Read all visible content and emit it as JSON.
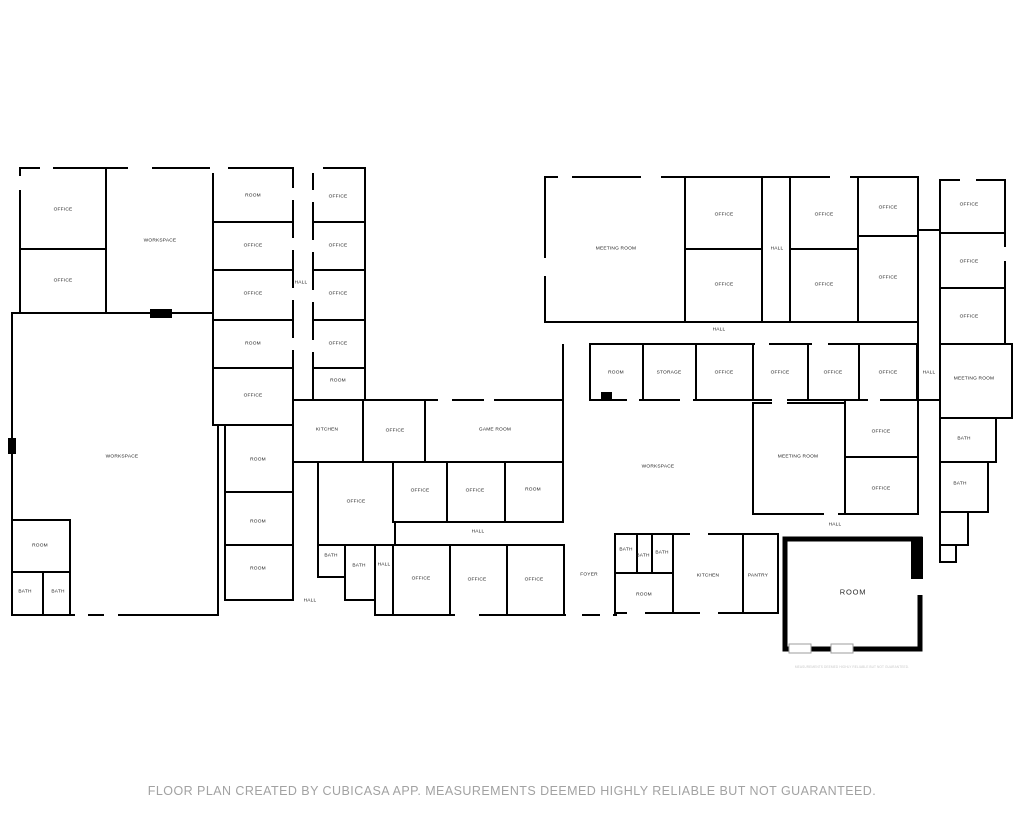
{
  "canvas": {
    "background": "#ffffff",
    "wall_color": "#000000",
    "label_color": "#1b1b1b",
    "muted_text_color": "#a2a2a2"
  },
  "footer": {
    "disclaimer": "FLOOR PLAN CREATED BY CUBICASA APP. MEASUREMENTS DEEMED HIGHLY RELIABLE BUT NOT GUARANTEED.",
    "fine_print": "MEASUREMENTS DEEMED HIGHLY RELIABLE BUT NOT GUARANTEED."
  },
  "rooms": [
    {
      "label": "OFFICE",
      "x": 63,
      "y": 211
    },
    {
      "label": "OFFICE",
      "x": 63,
      "y": 282
    },
    {
      "label": "WORKSPACE",
      "x": 160,
      "y": 242
    },
    {
      "label": "ROOM",
      "x": 253,
      "y": 197
    },
    {
      "label": "OFFICE",
      "x": 253,
      "y": 247
    },
    {
      "label": "OFFICE",
      "x": 253,
      "y": 295
    },
    {
      "label": "ROOM",
      "x": 253,
      "y": 345
    },
    {
      "label": "OFFICE",
      "x": 253,
      "y": 397
    },
    {
      "label": "HALL",
      "x": 301,
      "y": 284
    },
    {
      "label": "OFFICE",
      "x": 338,
      "y": 198
    },
    {
      "label": "OFFICE",
      "x": 338,
      "y": 247
    },
    {
      "label": "OFFICE",
      "x": 338,
      "y": 295
    },
    {
      "label": "OFFICE",
      "x": 338,
      "y": 345
    },
    {
      "label": "ROOM",
      "x": 338,
      "y": 382
    },
    {
      "label": "WORKSPACE",
      "x": 122,
      "y": 458
    },
    {
      "label": "ROOM",
      "x": 258,
      "y": 461
    },
    {
      "label": "ROOM",
      "x": 258,
      "y": 523
    },
    {
      "label": "ROOM",
      "x": 258,
      "y": 570
    },
    {
      "label": "ROOM",
      "x": 40,
      "y": 547
    },
    {
      "label": "BATH",
      "x": 25,
      "y": 593
    },
    {
      "label": "BATH",
      "x": 58,
      "y": 593
    },
    {
      "label": "KITCHEN",
      "x": 327,
      "y": 431
    },
    {
      "label": "OFFICE",
      "x": 356,
      "y": 503
    },
    {
      "label": "BATH",
      "x": 331,
      "y": 557
    },
    {
      "label": "BATH",
      "x": 359,
      "y": 567
    },
    {
      "label": "HALL",
      "x": 384,
      "y": 566
    },
    {
      "label": "HALL",
      "x": 310,
      "y": 602
    },
    {
      "label": "OFFICE",
      "x": 395,
      "y": 432
    },
    {
      "label": "GAME ROOM",
      "x": 495,
      "y": 431
    },
    {
      "label": "OFFICE",
      "x": 420,
      "y": 492
    },
    {
      "label": "OFFICE",
      "x": 475,
      "y": 492
    },
    {
      "label": "ROOM",
      "x": 533,
      "y": 491
    },
    {
      "label": "HALL",
      "x": 478,
      "y": 533
    },
    {
      "label": "OFFICE",
      "x": 421,
      "y": 580
    },
    {
      "label": "OFFICE",
      "x": 477,
      "y": 581
    },
    {
      "label": "OFFICE",
      "x": 534,
      "y": 581
    },
    {
      "label": "FOYER",
      "x": 589,
      "y": 576
    },
    {
      "label": "MEETING ROOM",
      "x": 616,
      "y": 250
    },
    {
      "label": "OFFICE",
      "x": 724,
      "y": 216
    },
    {
      "label": "OFFICE",
      "x": 724,
      "y": 286
    },
    {
      "label": "HALL",
      "x": 777,
      "y": 250
    },
    {
      "label": "HALL",
      "x": 719,
      "y": 331
    },
    {
      "label": "OFFICE",
      "x": 824,
      "y": 216
    },
    {
      "label": "OFFICE",
      "x": 888,
      "y": 209
    },
    {
      "label": "OFFICE",
      "x": 824,
      "y": 286
    },
    {
      "label": "OFFICE",
      "x": 888,
      "y": 279
    },
    {
      "label": "OFFICE",
      "x": 969,
      "y": 206
    },
    {
      "label": "OFFICE",
      "x": 969,
      "y": 263
    },
    {
      "label": "OFFICE",
      "x": 969,
      "y": 318
    },
    {
      "label": "HALL",
      "x": 929,
      "y": 374
    },
    {
      "label": "MEETING ROOM",
      "x": 974,
      "y": 380
    },
    {
      "label": "BATH",
      "x": 964,
      "y": 440
    },
    {
      "label": "BATH",
      "x": 960,
      "y": 485
    },
    {
      "label": "ROOM",
      "x": 616,
      "y": 374
    },
    {
      "label": "STORAGE",
      "x": 669,
      "y": 374
    },
    {
      "label": "OFFICE",
      "x": 724,
      "y": 374
    },
    {
      "label": "OFFICE",
      "x": 780,
      "y": 374
    },
    {
      "label": "OFFICE",
      "x": 833,
      "y": 374
    },
    {
      "label": "OFFICE",
      "x": 888,
      "y": 374
    },
    {
      "label": "WORKSPACE",
      "x": 658,
      "y": 468
    },
    {
      "label": "MEETING ROOM",
      "x": 798,
      "y": 458
    },
    {
      "label": "OFFICE",
      "x": 881,
      "y": 433
    },
    {
      "label": "OFFICE",
      "x": 881,
      "y": 490
    },
    {
      "label": "HALL",
      "x": 835,
      "y": 526
    },
    {
      "label": "BATH",
      "x": 626,
      "y": 551
    },
    {
      "label": "BATH",
      "x": 643,
      "y": 557
    },
    {
      "label": "BATH",
      "x": 662,
      "y": 554
    },
    {
      "label": "ROOM",
      "x": 644,
      "y": 596
    },
    {
      "label": "KITCHEN",
      "x": 708,
      "y": 577
    },
    {
      "label": "PANTRY",
      "x": 758,
      "y": 577
    },
    {
      "label": "ROOM",
      "x": 853,
      "y": 592,
      "size": "lg"
    }
  ]
}
